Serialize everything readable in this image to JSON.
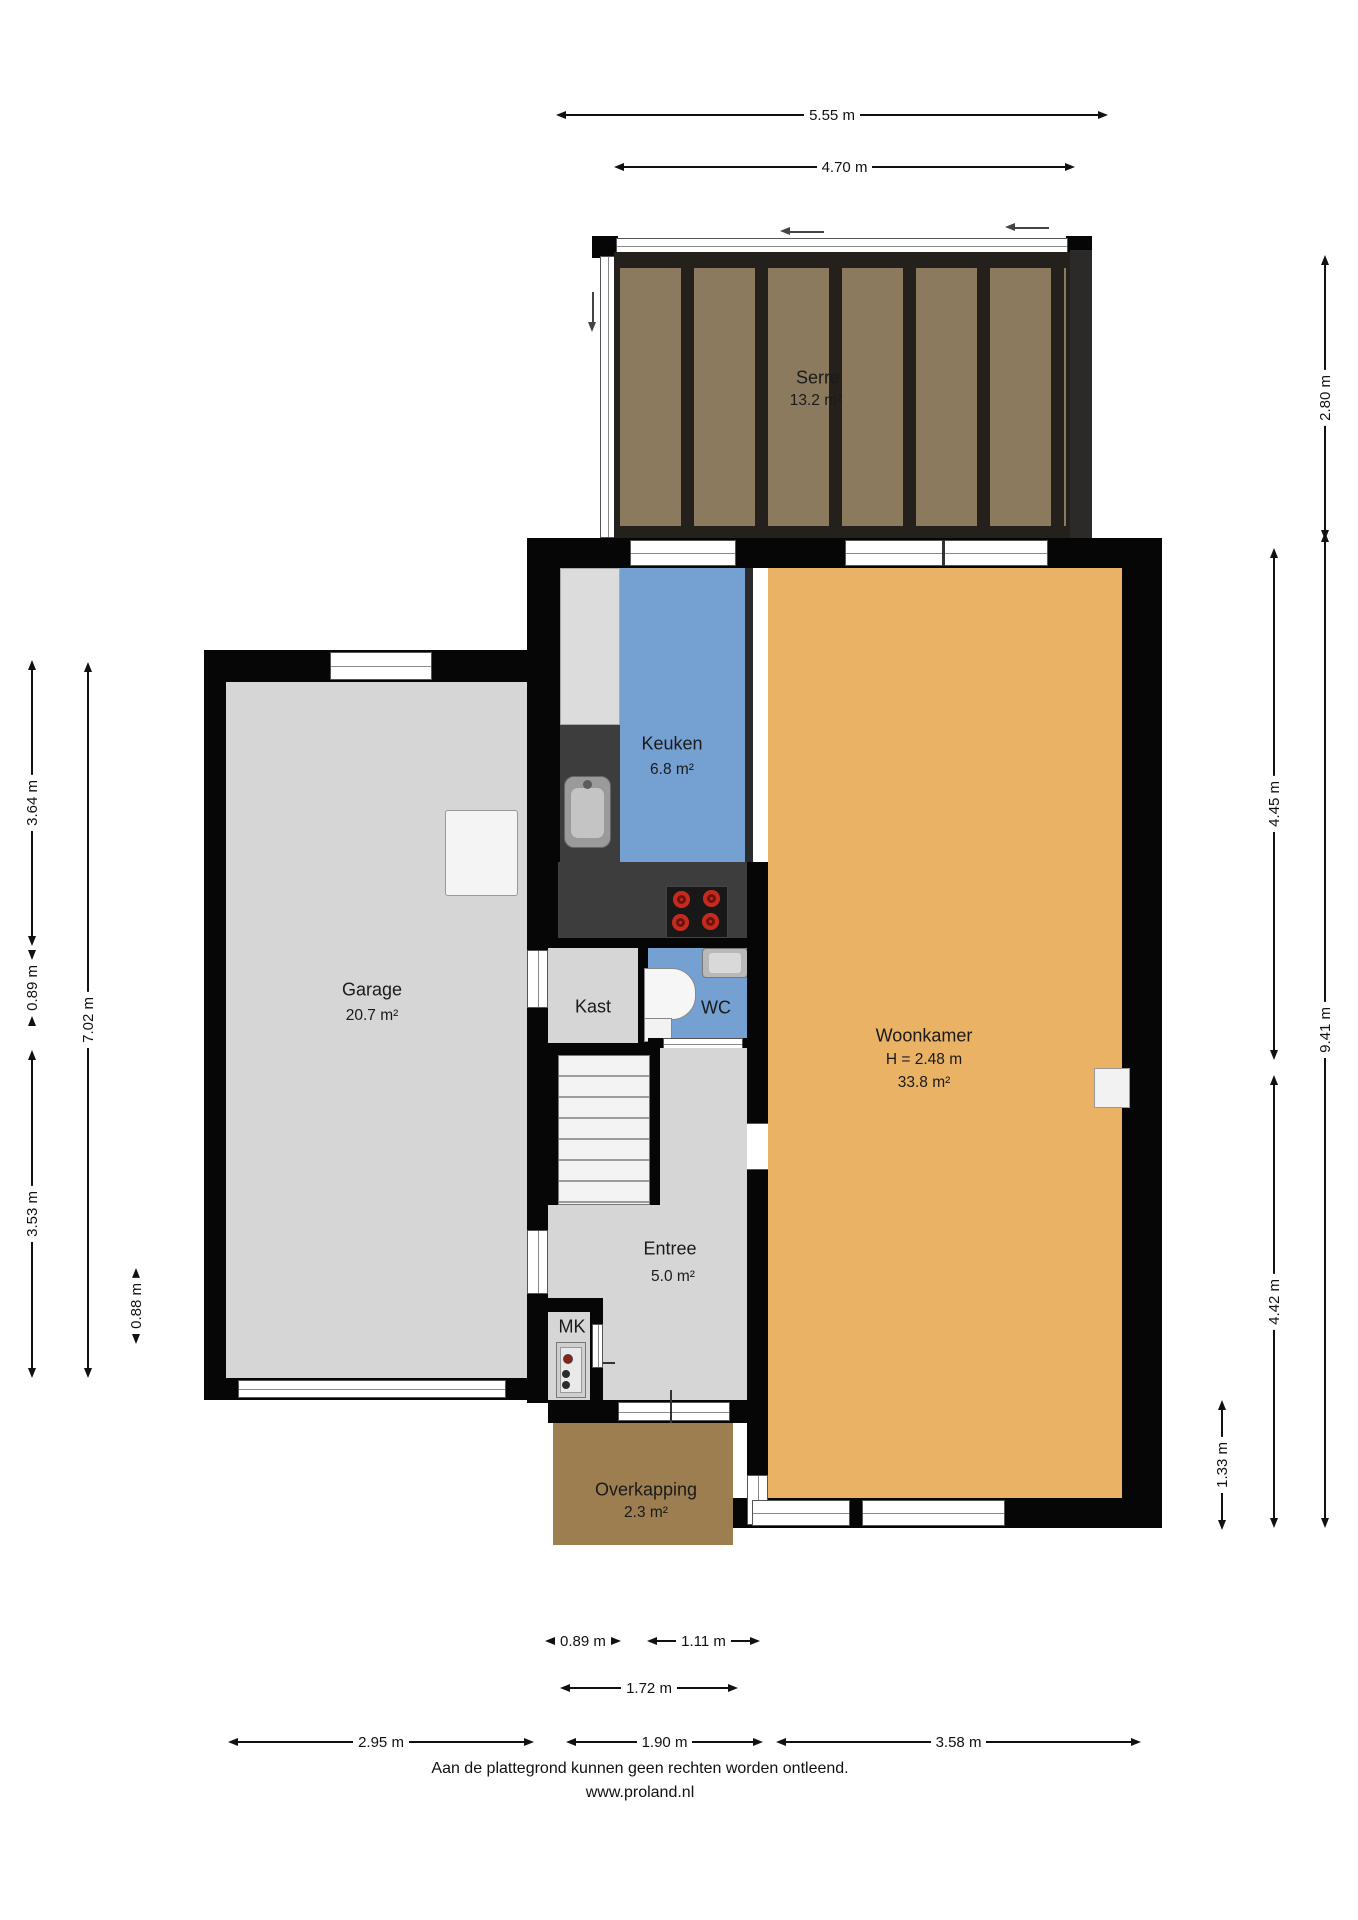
{
  "rooms": {
    "serre": {
      "name": "Serre",
      "area": "13.2 m²"
    },
    "keuken": {
      "name": "Keuken",
      "area": "6.8 m²"
    },
    "woonkamer": {
      "name": "Woonkamer",
      "ceiling_height": "H = 2.48 m",
      "area": "33.8 m²"
    },
    "garage": {
      "name": "Garage",
      "area": "20.7 m²"
    },
    "kast": {
      "name": "Kast"
    },
    "wc": {
      "name": "WC"
    },
    "entree": {
      "name": "Entree",
      "area": "5.0 m²"
    },
    "mk": {
      "name": "MK"
    },
    "overkapping": {
      "name": "Overkapping",
      "area": "2.3 m²"
    }
  },
  "dimensions": {
    "top_outer": "5.55 m",
    "top_inner": "4.70 m",
    "left_upper": "3.64 m",
    "left_small": "0.89 m",
    "left_lower": "3.53 m",
    "left_total": "7.02 m",
    "left_offset": "0.88 m",
    "right_serre": "2.80 m",
    "right_upper": "4.45 m",
    "right_total": "9.41 m",
    "right_lower": "4.42 m",
    "right_small": "1.33 m",
    "bottom_small_left": "0.89 m",
    "bottom_door": "1.11 m",
    "bottom_porch": "1.72 m",
    "bottom_garage": "2.95 m",
    "bottom_entree": "1.90 m",
    "bottom_living": "3.58 m"
  },
  "footer": {
    "disclaimer": "Aan de plattegrond kunnen geen rechten worden ontleend.",
    "website": "www.proland.nl"
  },
  "colors": {
    "wall": "#060606",
    "living_floor": "#e9b264",
    "kitchen_floor": "#75a0d2",
    "garage_floor": "#d6d6d6",
    "serre_panel": "#8b7a5d",
    "overkapping_floor": "#9c7e50",
    "counter": "#3d3d3d",
    "burner": "#c42b1f"
  }
}
